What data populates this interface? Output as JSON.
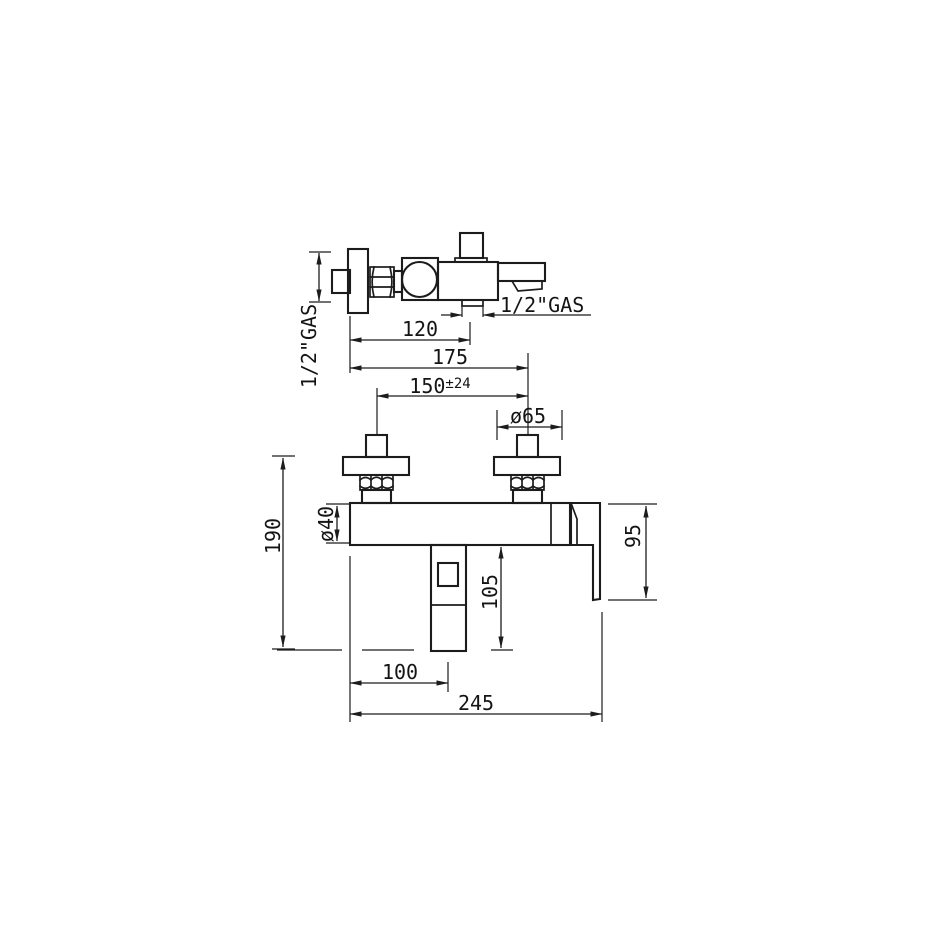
{
  "page": {
    "background": "#ffffff",
    "line_color": "#1c1c1c",
    "text_color": "#141414"
  },
  "drawing": {
    "side_view": {
      "inlet_thread_label": "1/2\"GAS",
      "outlet_thread_label": "1/2\"GAS"
    },
    "dimensions": {
      "projection_120": "120",
      "depth_175": "175",
      "centers_150": "150",
      "centers_tolerance": "±24",
      "flange_diameter_65": "ø65",
      "height_190": "190",
      "body_diameter_40": "ø40",
      "spout_drop_105": "105",
      "lever_height_95": "95",
      "spout_offset_100": "100",
      "overall_width_245": "245"
    }
  }
}
